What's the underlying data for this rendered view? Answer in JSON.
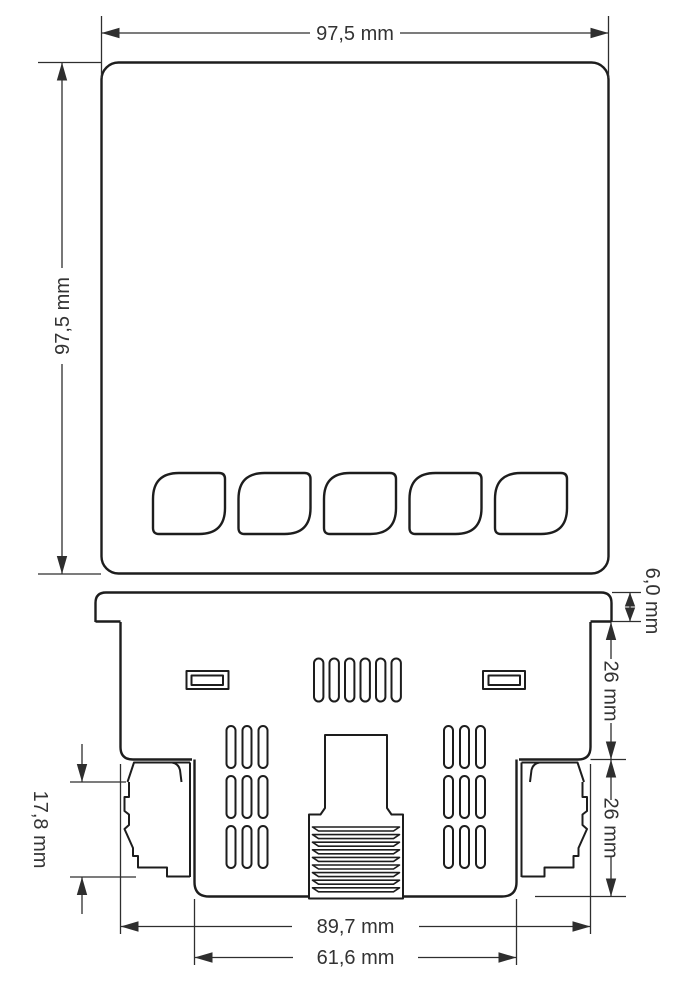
{
  "drawing": {
    "type": "mechanical-dimension-drawing",
    "background_color": "#ffffff",
    "outline_color": "#1d1d1d",
    "dimension_color": "#2e2e2e",
    "text_color": "#333333",
    "dimensions": {
      "front_width": "97,5 mm",
      "front_height": "97,5 mm",
      "bezel_thickness": "6,0 mm",
      "upper_depth": "26 mm",
      "lower_depth": "26 mm",
      "clip_height": "17,8 mm",
      "case_width": "89,7 mm",
      "terminal_width": "61,6 mm"
    }
  }
}
